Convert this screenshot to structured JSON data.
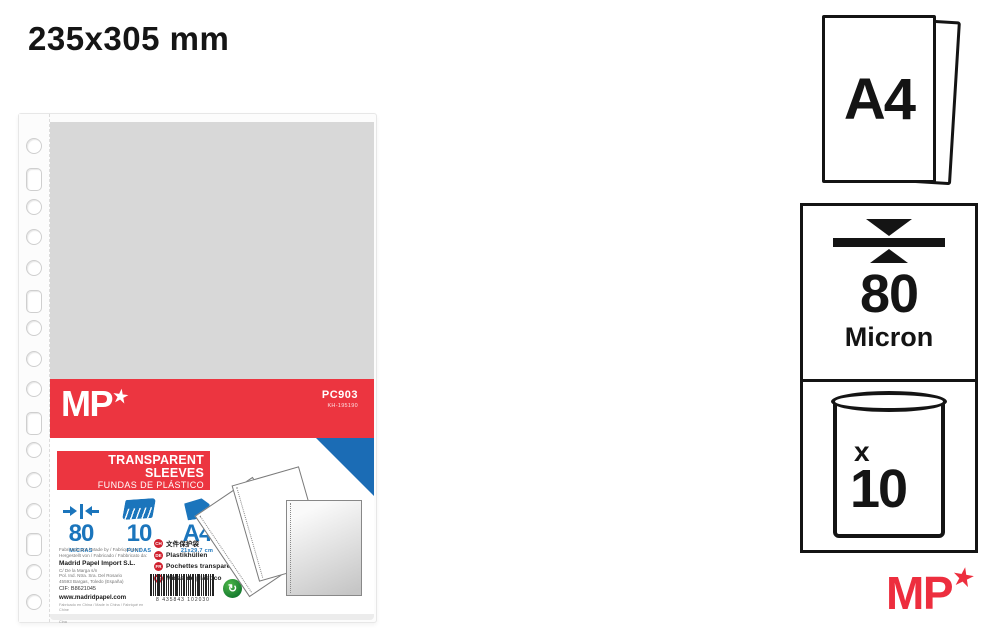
{
  "page": {
    "title": "235x305 mm"
  },
  "colors": {
    "brand_red": "#EC3540",
    "logo_red": "#ED2E3E",
    "brand_blue": "#1B75BC",
    "triangle_blue": "#1B6CB5",
    "insert_gray": "#D8D8D8",
    "icon_black": "#141414",
    "green_dot": "#157A2E"
  },
  "photo_label": {
    "brand": "MP",
    "brand_star": "★",
    "sku": "PC903",
    "sku_sub": "KH-195190",
    "title_en": "TRANSPARENT SLEEVES",
    "title_es": "FUNDAS DE PLÁSTICO",
    "title_it": "BUSTE A PERFORAZIONE",
    "specs": [
      {
        "icon": "thickness-arrows-icon",
        "value": "80",
        "label": "MICRAS"
      },
      {
        "icon": "sheet-stack-icon",
        "value": "10",
        "label": "FUNDAS"
      },
      {
        "icon": "folded-sheet-icon",
        "value": "A4",
        "label": "21x29.7 cm"
      }
    ],
    "languages": [
      {
        "code": "CH",
        "label": "文件保护袋"
      },
      {
        "code": "DE",
        "label": "Plastikhüllen"
      },
      {
        "code": "FR",
        "label": "Pochettes transparentes"
      },
      {
        "code": "PT",
        "label": "Micas de plástico"
      }
    ],
    "manufacturer": {
      "made_by_line1": "Fabricado por / Made by / Fabriqué par /",
      "made_by_line2": "Hergestellt von / Fabricado / Fabbricato da:",
      "company": "Madrid Papel Import S.L.",
      "address1": "C/ De la Marga s/n",
      "address2": "Pol. Ind. Ntra. Sra. Del Rosario",
      "address3": "45593 Bargas, Toledo (España)",
      "cif": "CIF: B8621045",
      "web": "www.madridpapel.com",
      "footnote1": "Fabricado en China / Made in China / Fabriqué en Chine",
      "footnote2": "Hergestellt in China / Fabricado na China / Prodotto in Cina"
    },
    "barcode_digits": "8 435843 102030",
    "holes_count": 16
  },
  "side_panels": {
    "format_label": "A4",
    "thickness_value": "80",
    "thickness_unit": "Micron",
    "qty_prefix": "x",
    "qty_value": "10",
    "brand": "MP",
    "brand_star": "★"
  }
}
